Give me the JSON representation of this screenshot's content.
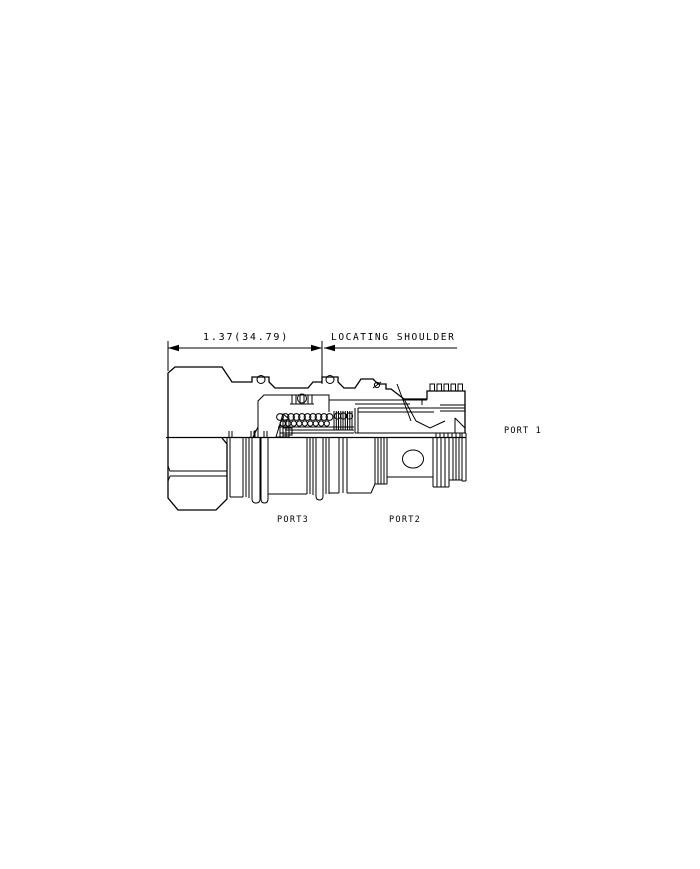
{
  "drawing": {
    "dimension": {
      "label": "1.37(34.79)"
    },
    "callout": {
      "label": "LOCATING SHOULDER"
    },
    "ports": {
      "port1": "PORT 1",
      "port2": "PORT2",
      "port3": "PORT3"
    },
    "colors": {
      "line": "#000000",
      "background": "#ffffff"
    }
  }
}
